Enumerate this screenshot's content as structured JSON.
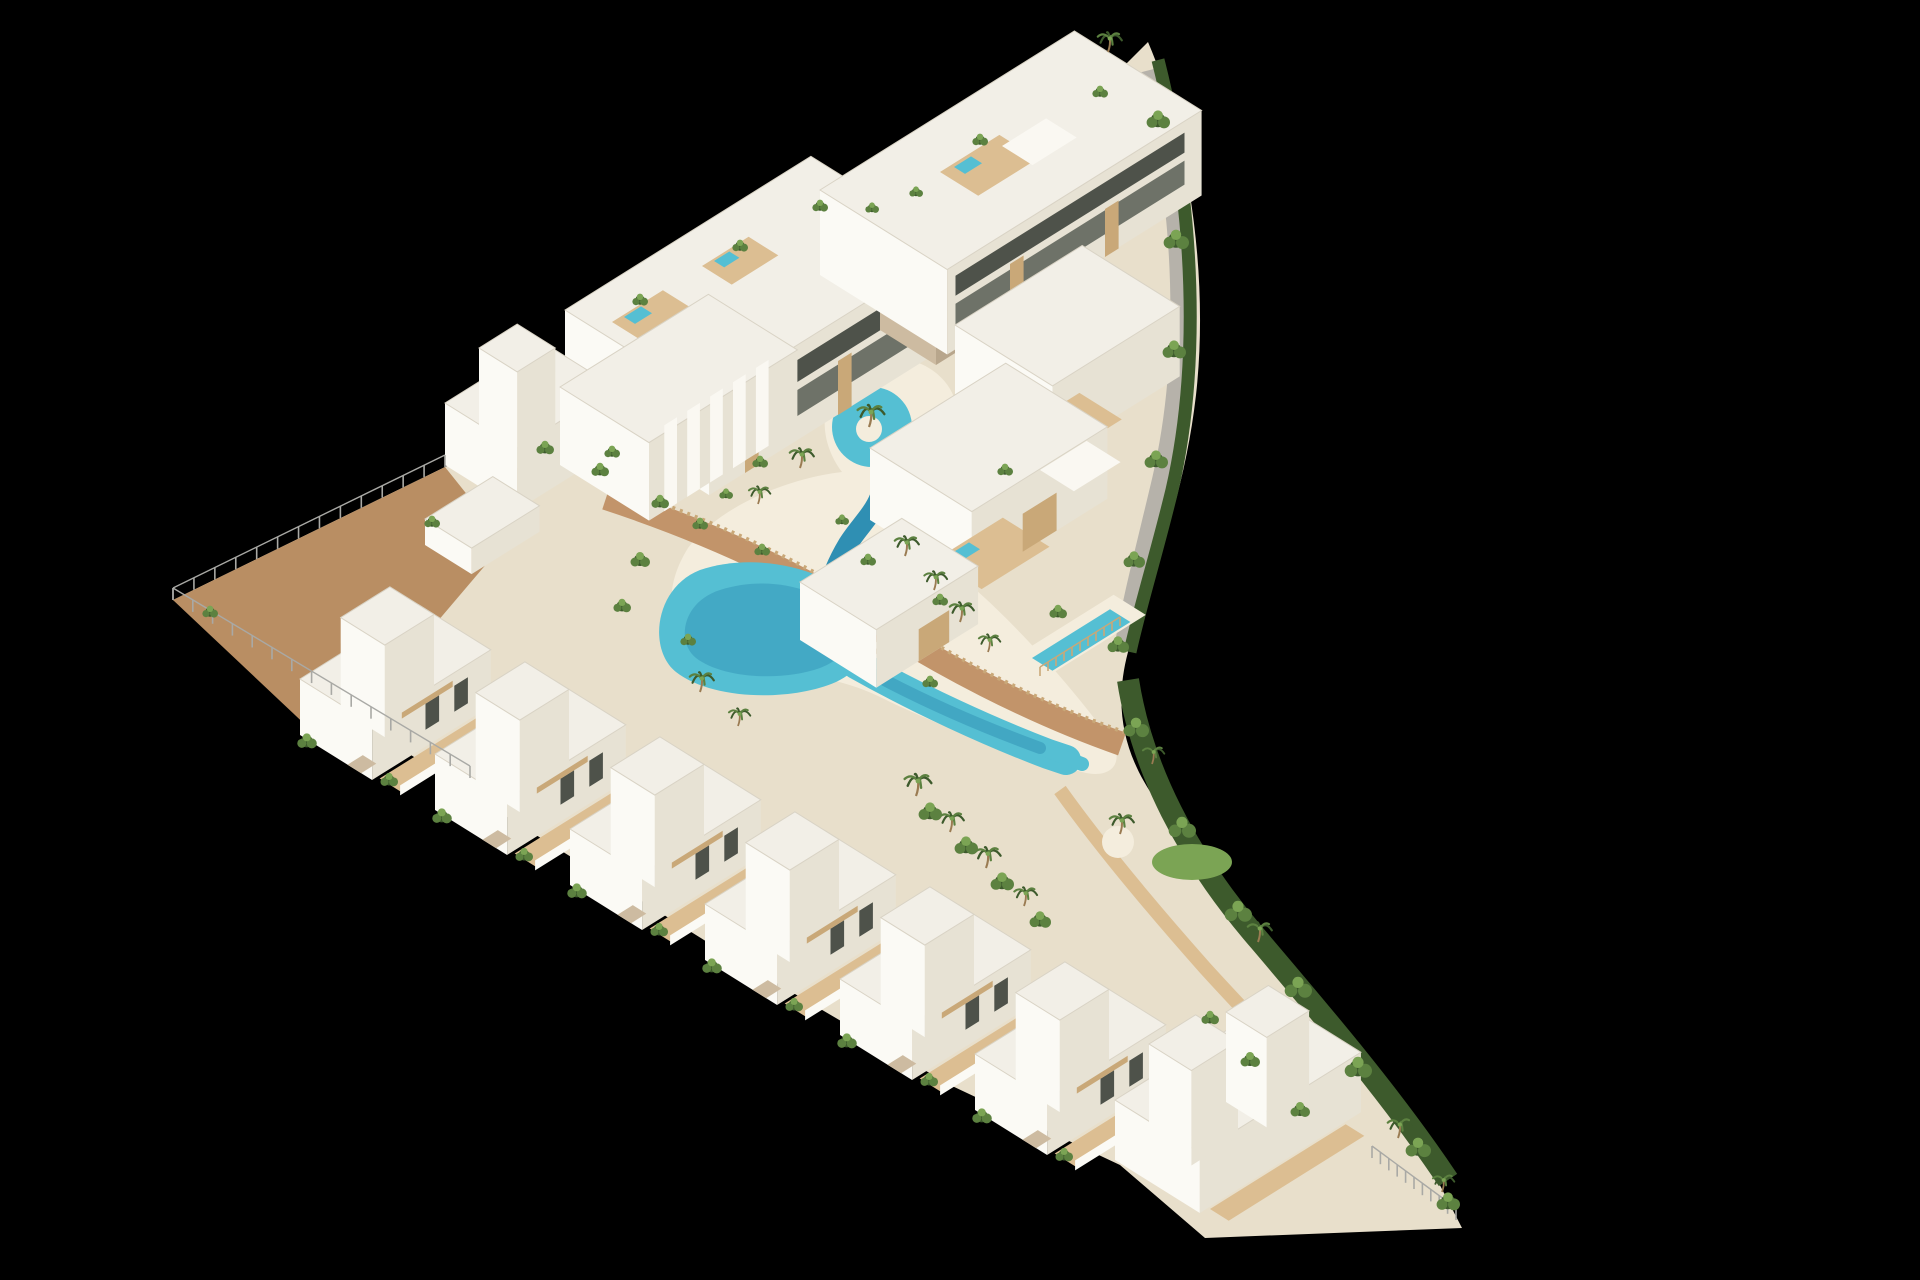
{
  "meta": {
    "description": "Aerial 3D architectural render of a triangular coastal residential development with white Ibiza-style villas and apartments, a winding turquoise lagoon pool with a sandy beach edge, palm trees, wooden boardwalks and a hedge-lined curved boundary, isolated on a black background",
    "inventory": {
      "apartment_buildings": 2,
      "row_villas": 8,
      "terraced_villas_right": 3,
      "lagoon_pools": 1,
      "private_pools": 1,
      "rooftop_jacuzzis": 5,
      "bridges": 1
    }
  },
  "palette": {
    "bg": "#000000",
    "sand": "#E8DFCB",
    "beach": "#F4EDDD",
    "pave": "#B98E63",
    "pathGray": "#B6B2AA",
    "deck": "#C2946A",
    "deckLight": "#DCBE92",
    "woodWall": "#C9A878",
    "roof": "#F2EFE7",
    "roofBright": "#FAF8F2",
    "roofEdge": "#D9D3C5",
    "faceLight": "#FBFAF5",
    "faceShade": "#E7E2D4",
    "stone": "#CDBBA1",
    "stoneDark": "#B8A68C",
    "glass": "#6E7268",
    "glassDark": "#4E524A",
    "pool": "#55BFD3",
    "poolDeep": "#2F8FB3",
    "hedge": "#3D5A2C",
    "green": "#5C8140",
    "greenLight": "#7BA454",
    "trunk": "#9A7B52",
    "fence": "#A9A9A5"
  },
  "iso": {
    "e1": [
      0.848,
      -0.53
    ],
    "e2": [
      0.848,
      0.53
    ]
  },
  "scene": [
    {
      "t": "path",
      "name": "site-ground",
      "d": "M173,600 L445,467 L565,405 L811,251 L820,275 L1074,116 L1148,42 C1186,130 1210,270 1196,395 C1184,500 1150,580 1128,652 C1112,712 1126,760 1160,806 C1214,878 1300,980 1392,1092 L1462,1228 L1205,1238 L1120,1165 L950,1085 L720,950 L480,800 Z",
      "fill": "sand"
    },
    {
      "t": "path",
      "name": "tip-paving",
      "d": "M173,600 L445,467 L505,542 L330,748 Z",
      "fill": "pave"
    },
    {
      "t": "path",
      "name": "beach",
      "d": "M688,548 C720,505 790,478 842,472 C812,432 822,382 864,364 C908,346 956,372 958,416 C960,450 938,476 906,484 C938,522 958,556 976,590 C1026,634 1082,700 1112,742 C1124,762 1112,780 1082,772 C1020,756 938,726 878,696 C836,676 788,672 738,664 C678,654 652,606 688,548 Z",
      "fill": "beach"
    },
    {
      "t": "path",
      "name": "gray-path",
      "d": "M1150,70 C1186,210 1190,360 1162,480 C1146,548 1132,600 1124,650",
      "stroke": "pathGray",
      "w": 20
    },
    {
      "t": "path",
      "name": "hedge-right",
      "d": "M1158,60 C1196,210 1200,368 1172,490 C1156,556 1140,606 1130,652",
      "stroke": "hedge",
      "w": 13
    },
    {
      "t": "path",
      "name": "hedge-bottom-right",
      "d": "M1128,680 C1142,770 1188,856 1252,932 C1320,1012 1392,1096 1448,1180",
      "stroke": "hedge",
      "w": 22
    },
    {
      "t": "path",
      "name": "sand-path-bottom-right",
      "d": "M1060,790 C1100,846 1150,906 1205,968 C1245,1012 1282,1050 1318,1088",
      "stroke": "deckLight",
      "w": 14
    },
    {
      "t": "ellipse",
      "name": "lawn-patch",
      "c": [
        1192,
        862
      ],
      "rx": 40,
      "ry": 18,
      "fill": "greenLight"
    },
    {
      "t": "circle",
      "name": "palm-island-south",
      "c": [
        1118,
        842
      ],
      "r": 16,
      "fill": "beach"
    },
    {
      "t": "path",
      "name": "boardwalk",
      "d": "M606,498 C716,534 800,576 866,616 C936,662 1030,712 1122,744",
      "stroke": "deck",
      "w": 24
    },
    {
      "t": "path",
      "name": "boardwalk-slat-fence",
      "d": "M612,486 C720,522 804,564 870,604 C940,650 1032,700 1124,732",
      "stroke": "woodWall",
      "w": 4,
      "dash": "3 5"
    },
    {
      "t": "path",
      "name": "deck-path-right",
      "d": "M978,432 C950,500 912,576 882,656",
      "stroke": "deck",
      "w": 16
    },
    {
      "t": "circle",
      "name": "pool-loop",
      "c": [
        872,
        427
      ],
      "r": 40,
      "fill": "pool"
    },
    {
      "t": "circle",
      "name": "pool-island",
      "c": [
        869,
        429
      ],
      "r": 13,
      "fill": "beach"
    },
    {
      "t": "path",
      "name": "pool-channel",
      "d": "M880,462 C892,500 864,518 848,544 C836,564 830,580 827,596",
      "stroke": "poolDeep",
      "w": 20,
      "cap": "round"
    },
    {
      "t": "path",
      "name": "pool-lagoon-upper",
      "d": "M700,570 C760,550 830,572 856,600 C880,626 874,664 836,682 C790,702 712,700 676,672 C648,650 654,588 700,570 Z",
      "fill": "pool"
    },
    {
      "t": "path",
      "name": "pool-lagoon-upper-deep",
      "d": "M720,590 C770,574 820,590 842,612 C858,630 852,656 820,668 C780,682 722,678 696,658 C676,642 682,602 720,590 Z",
      "fill": "poolDeep",
      "op": 0.45
    },
    {
      "t": "path",
      "name": "pool-lagoon-lower",
      "d": "M856,664 C920,700 990,732 1048,754 L1066,760",
      "stroke": "pool",
      "w": 30,
      "cap": "round"
    },
    {
      "t": "path",
      "name": "pool-lagoon-lower-tail",
      "d": "M1040,748 L1082,764",
      "stroke": "pool",
      "w": 14,
      "cap": "round"
    },
    {
      "t": "path",
      "name": "pool-lagoon-lower-deep",
      "d": "M862,668 C920,700 980,726 1040,748",
      "stroke": "poolDeep",
      "w": 12,
      "cap": "round",
      "op": 0.5
    },
    {
      "t": "gquad",
      "name": "pool-bridge",
      "o": [
        838,
        650
      ],
      "a": 42,
      "b": 15,
      "fill": "deck"
    },
    {
      "t": "fence",
      "name": "bridge-rail",
      "p1": [
        842,
        656
      ],
      "p2": [
        876,
        635
      ],
      "gap": 8,
      "h": 8
    },
    {
      "t": "block",
      "name": "apartment-building-a",
      "o": [
        565,
        405
      ],
      "a": 290,
      "b": 170,
      "h": 95
    },
    {
      "t": "vquad",
      "name": "apt-a-balcony-lower",
      "o": [
        717.7,
        489.8
      ],
      "lift": 24,
      "d": [
        224.7,
        -140.5
      ],
      "h": 26,
      "fill": "glass"
    },
    {
      "t": "vquad",
      "name": "apt-a-balcony-upper",
      "o": [
        717.7,
        489.8
      ],
      "lift": 58,
      "d": [
        224.7,
        -140.5
      ],
      "h": 22,
      "fill": "glassDark"
    },
    {
      "t": "vquad",
      "name": "apt-a-wood-pillar-1",
      "o": [
        745,
        473
      ],
      "d": [
        13.6,
        -8.5
      ],
      "h": 58,
      "fill": "woodWall"
    },
    {
      "t": "vquad",
      "name": "apt-a-wood-pillar-2",
      "o": [
        838,
        415
      ],
      "d": [
        13.6,
        -8.5
      ],
      "h": 54,
      "fill": "woodWall"
    },
    {
      "t": "gquad",
      "name": "apt-a-roof-deck-1",
      "o": [
        612,
        322
      ],
      "a": 60,
      "b": 40,
      "fill": "deckLight"
    },
    {
      "t": "gquad",
      "name": "apt-a-rooftop-jacuzzi-1",
      "o": [
        624,
        317
      ],
      "a": 20,
      "b": 13,
      "fill": "pool"
    },
    {
      "t": "gquad",
      "name": "apt-a-roof-deck-2",
      "o": [
        702,
        266
      ],
      "a": 55,
      "b": 35,
      "fill": "deckLight"
    },
    {
      "t": "gquad",
      "name": "apt-a-rooftop-jacuzzi-2",
      "o": [
        714,
        261
      ],
      "a": 18,
      "b": 12,
      "fill": "pool"
    },
    {
      "t": "block",
      "name": "apartment-stair-core",
      "o": [
        880,
        330
      ],
      "a": 44,
      "b": 66,
      "h": 108,
      "roof": "roofBright",
      "fl": "stone",
      "fr": "stoneDark"
    },
    {
      "t": "block",
      "name": "apartment-building-b",
      "o": [
        820,
        275
      ],
      "a": 300,
      "b": 150,
      "h": 85
    },
    {
      "t": "vquad",
      "name": "apt-b-balcony-lower",
      "o": [
        955.5,
        349.7
      ],
      "lift": 22,
      "d": [
        229,
        -143.1
      ],
      "h": 24,
      "fill": "glass"
    },
    {
      "t": "vquad",
      "name": "apt-b-balcony-upper",
      "o": [
        955.5,
        349.7
      ],
      "lift": 54,
      "d": [
        229,
        -143.1
      ],
      "h": 20,
      "fill": "glassDark"
    },
    {
      "t": "vquad",
      "name": "apt-b-wood-pillar-1",
      "o": [
        1010,
        316
      ],
      "d": [
        13.6,
        -8.5
      ],
      "h": 52,
      "fill": "woodWall"
    },
    {
      "t": "vquad",
      "name": "apt-b-wood-pillar-2",
      "o": [
        1105,
        257
      ],
      "d": [
        13.6,
        -8.5
      ],
      "h": 48,
      "fill": "woodWall"
    },
    {
      "t": "gquad",
      "name": "apt-b-roof-deck",
      "o": [
        940,
        172
      ],
      "a": 70,
      "b": 45,
      "fill": "deckLight"
    },
    {
      "t": "gquad",
      "name": "apt-b-rooftop-jacuzzi",
      "o": [
        954,
        167
      ],
      "a": 20,
      "b": 13,
      "fill": "pool"
    },
    {
      "t": "gquad",
      "name": "apt-b-roof-pergola",
      "o": [
        1002,
        146
      ],
      "a": 52,
      "b": 36,
      "fill": "roofBright"
    },
    {
      "t": "block",
      "name": "villa-middle-west",
      "o": [
        445,
        465
      ],
      "a": 115,
      "b": 85,
      "h": 62
    },
    {
      "t": "block",
      "name": "villa-middle-west-tower",
      "o": [
        479,
        444
      ],
      "a": 45,
      "b": 45,
      "h": 96
    },
    {
      "t": "block",
      "name": "villa-arches",
      "o": [
        560,
        465
      ],
      "a": 175,
      "b": 105,
      "h": 78
    },
    {
      "t": "vquad",
      "name": "villa-arches-fin-1",
      "o": [
        664.3,
        511.2
      ],
      "d": [
        12.7,
        -8
      ],
      "h": 86,
      "fill": "roofBright"
    },
    {
      "t": "vquad",
      "name": "villa-arches-fin-2",
      "o": [
        687.2,
        496.9
      ],
      "d": [
        12.7,
        -8
      ],
      "h": 86,
      "fill": "roofBright"
    },
    {
      "t": "vquad",
      "name": "villa-arches-fin-3",
      "o": [
        710.1,
        482.5
      ],
      "d": [
        12.7,
        -8
      ],
      "h": 86,
      "fill": "roofBright"
    },
    {
      "t": "vquad",
      "name": "villa-arches-fin-4",
      "o": [
        733,
        468.2
      ],
      "d": [
        12.7,
        -8
      ],
      "h": 86,
      "fill": "roofBright"
    },
    {
      "t": "vquad",
      "name": "villa-arches-fin-5",
      "o": [
        755.9,
        453.9
      ],
      "d": [
        12.7,
        -8
      ],
      "h": 86,
      "fill": "roofBright"
    },
    {
      "t": "block",
      "name": "garden-wall-structure",
      "o": [
        425,
        545
      ],
      "a": 80,
      "b": 55,
      "h": 26
    },
    {
      "t": "block",
      "name": "villa-right-1",
      "o": [
        955,
        395
      ],
      "a": 150,
      "b": 115,
      "h": 70
    },
    {
      "t": "gquad",
      "name": "villa-right-1-deck",
      "o": [
        1020,
        430
      ],
      "a": 70,
      "b": 50,
      "fill": "deckLight"
    },
    {
      "t": "gquad",
      "name": "villa-right-1-jacuzzi",
      "o": [
        1036,
        424
      ],
      "a": 20,
      "b": 13,
      "fill": "pool"
    },
    {
      "t": "block",
      "name": "villa-right-2",
      "o": [
        870,
        520
      ],
      "a": 160,
      "b": 120,
      "h": 72
    },
    {
      "t": "gquad",
      "name": "villa-right-2-deck",
      "o": [
        935,
        560
      ],
      "a": 80,
      "b": 55,
      "fill": "deckLight"
    },
    {
      "t": "gquad",
      "name": "villa-right-2-jacuzzi",
      "o": [
        952,
        553
      ],
      "a": 20,
      "b": 13,
      "fill": "pool"
    },
    {
      "t": "gquad",
      "name": "villa-right-pergola",
      "o": [
        1040,
        470
      ],
      "a": 55,
      "b": 40,
      "fill": "roofBright"
    },
    {
      "t": "vquad",
      "name": "villa-right-2-wood-screen",
      "o": [
        1022.7,
        551.8
      ],
      "d": [
        33.9,
        -21.2
      ],
      "h": 38,
      "fill": "woodWall"
    },
    {
      "t": "block",
      "name": "villa-right-3",
      "o": [
        800,
        640
      ],
      "a": 120,
      "b": 90,
      "h": 58
    },
    {
      "t": "vquad",
      "name": "villa-right-3-wood-screen",
      "o": [
        918.7,
        661.2
      ],
      "d": [
        30.5,
        -19.1
      ],
      "h": 32,
      "fill": "woodWall"
    },
    {
      "t": "gquad",
      "name": "private-pool-surround",
      "o": [
        1022,
        652
      ],
      "a": 108,
      "b": 38,
      "fill": "beach"
    },
    {
      "t": "gquad",
      "name": "private-pool",
      "o": [
        1032,
        658
      ],
      "a": 92,
      "b": 24,
      "fill": "pool"
    },
    {
      "t": "fence",
      "name": "private-pool-fence",
      "p1": [
        1040,
        676
      ],
      "p2": [
        1120,
        626
      ],
      "gap": 9,
      "h": 9,
      "color": "woodWall"
    },
    {
      "t": "villa",
      "name": "row-villa-1",
      "o": [
        300,
        735
      ]
    },
    {
      "t": "villa",
      "name": "row-villa-2",
      "o": [
        435,
        810
      ]
    },
    {
      "t": "villa",
      "name": "row-villa-3",
      "o": [
        570,
        885
      ]
    },
    {
      "t": "villa",
      "name": "row-villa-4",
      "o": [
        705,
        960
      ]
    },
    {
      "t": "villa",
      "name": "row-villa-5",
      "o": [
        840,
        1035
      ]
    },
    {
      "t": "villa",
      "name": "row-villa-6",
      "o": [
        975,
        1110
      ]
    },
    {
      "t": "block",
      "name": "corner-villa",
      "o": [
        1115,
        1160
      ],
      "a": 190,
      "b": 100,
      "h": 60
    },
    {
      "t": "block",
      "name": "corner-villa-tower-1",
      "o": [
        1149,
        1139
      ],
      "a": 55,
      "b": 50,
      "h": 95
    },
    {
      "t": "block",
      "name": "corner-villa-tower-2",
      "o": [
        1226,
        1102
      ],
      "a": 50,
      "b": 48,
      "h": 90
    },
    {
      "t": "gquad",
      "name": "corner-villa-deck",
      "o": [
        1210,
        1209
      ],
      "a": 160,
      "b": 22,
      "fill": "deckLight"
    },
    {
      "t": "fence",
      "name": "corner-glass-fence",
      "p1": [
        1372,
        1158
      ],
      "p2": [
        1456,
        1220
      ],
      "gap": 10,
      "h": 12
    },
    {
      "t": "fence",
      "name": "fence-northwest",
      "p1": [
        173,
        600
      ],
      "p2": [
        445,
        467
      ],
      "gap": 22,
      "h": 12
    },
    {
      "t": "fence",
      "name": "fence-southwest",
      "p1": [
        173,
        600
      ],
      "p2": [
        470,
        778
      ],
      "gap": 22,
      "h": 12
    }
  ],
  "palms": [
    [
      869,
      427,
      1
    ],
    [
      800,
      468,
      0.9
    ],
    [
      758,
      504,
      0.8
    ],
    [
      905,
      556,
      0.9
    ],
    [
      934,
      590,
      0.85
    ],
    [
      960,
      622,
      0.9
    ],
    [
      988,
      652,
      0.8
    ],
    [
      700,
      692,
      0.9
    ],
    [
      738,
      726,
      0.8
    ],
    [
      916,
      796,
      1
    ],
    [
      950,
      832,
      0.9
    ],
    [
      986,
      868,
      0.95
    ],
    [
      1024,
      906,
      0.85
    ],
    [
      1120,
      834,
      0.9
    ],
    [
      1152,
      764,
      0.8
    ],
    [
      1258,
      942,
      0.9
    ],
    [
      1398,
      1138,
      0.9
    ],
    [
      1108,
      52,
      0.9
    ],
    [
      1442,
      1192,
      0.8
    ]
  ],
  "shrubs": [
    [
      1158,
      120,
      1.2
    ],
    [
      1176,
      240,
      1.3
    ],
    [
      1174,
      350,
      1.2
    ],
    [
      1156,
      460,
      1.2
    ],
    [
      1134,
      560,
      1.1
    ],
    [
      1118,
      645,
      1.1
    ],
    [
      1136,
      728,
      1.3
    ],
    [
      1182,
      828,
      1.4
    ],
    [
      1238,
      912,
      1.4
    ],
    [
      1298,
      988,
      1.4
    ],
    [
      1358,
      1068,
      1.4
    ],
    [
      1418,
      1148,
      1.3
    ],
    [
      1448,
      1202,
      1.2
    ],
    [
      930,
      812,
      1.2
    ],
    [
      966,
      846,
      1.2
    ],
    [
      1002,
      882,
      1.2
    ],
    [
      1040,
      920,
      1.1
    ],
    [
      640,
      300,
      0.8
    ],
    [
      740,
      246,
      0.8
    ],
    [
      820,
      206,
      0.8
    ],
    [
      872,
      208,
      0.7
    ],
    [
      980,
      140,
      0.8
    ],
    [
      1100,
      92,
      0.8
    ],
    [
      916,
      192,
      0.7
    ],
    [
      600,
      470,
      0.9
    ],
    [
      660,
      502,
      0.9
    ],
    [
      700,
      524,
      0.8
    ],
    [
      762,
      550,
      0.8
    ],
    [
      545,
      448,
      0.9
    ],
    [
      612,
      452,
      0.8
    ],
    [
      432,
      522,
      0.8
    ],
    [
      210,
      612,
      0.8
    ],
    [
      640,
      560,
      1
    ],
    [
      622,
      606,
      0.9
    ],
    [
      688,
      640,
      0.8
    ],
    [
      868,
      560,
      0.8
    ],
    [
      842,
      520,
      0.7
    ],
    [
      760,
      462,
      0.8
    ],
    [
      726,
      494,
      0.7
    ],
    [
      1005,
      470,
      0.8
    ],
    [
      940,
      600,
      0.8
    ],
    [
      1058,
      612,
      0.9
    ],
    [
      930,
      682,
      0.8
    ],
    [
      1250,
      1060,
      1
    ],
    [
      1300,
      1110,
      1
    ],
    [
      1210,
      1018,
      0.9
    ]
  ]
}
